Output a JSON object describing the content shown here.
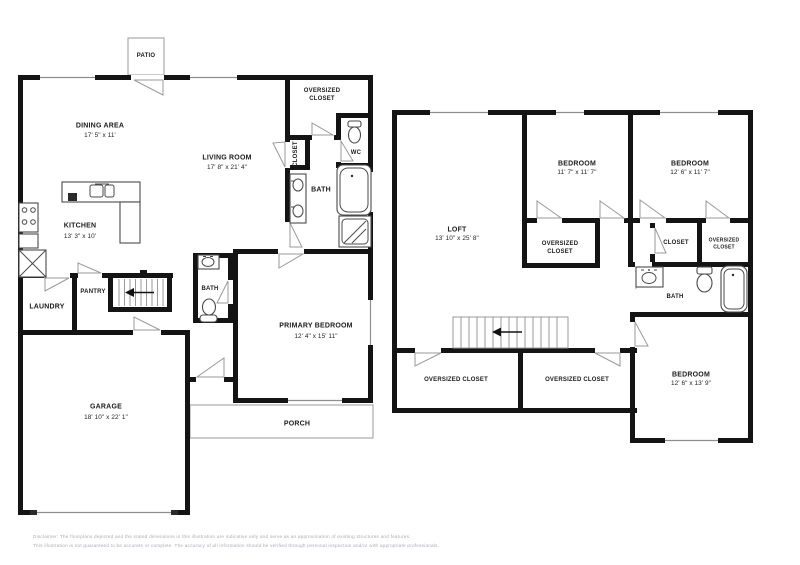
{
  "meta": {
    "width": 800,
    "height": 565,
    "background": "#ffffff",
    "wall_color": "#141414",
    "thin_line_color": "#9a9a9a",
    "text_color": "#1b1b1b",
    "disclaimer_color": "#a9a9b6"
  },
  "floor1": {
    "patio": "PATIO",
    "dining_area": {
      "name": "DINING AREA",
      "dims": "17' 5\" x 11'"
    },
    "living_room": {
      "name": "LIVING ROOM",
      "dims": "17' 8\" x 21' 4\""
    },
    "kitchen": {
      "name": "KITCHEN",
      "dims": "13' 3\" x 10'"
    },
    "oversized_closet": {
      "name": "OVERSIZED\nCLOSET"
    },
    "wc": {
      "name": "WC"
    },
    "closet": {
      "name": "CLOSET"
    },
    "bath_upper": {
      "name": "BATH"
    },
    "laundry": {
      "name": "LAUNDRY"
    },
    "pantry": {
      "name": "PANTRY"
    },
    "bath_hall": {
      "name": "BATH"
    },
    "primary_bedroom": {
      "name": "PRIMARY BEDROOM",
      "dims": "12' 4\" x 15' 11\""
    },
    "garage": {
      "name": "GARAGE",
      "dims": "18' 10\" x 22' 1\""
    },
    "porch": {
      "name": "PORCH"
    }
  },
  "floor2": {
    "loft": {
      "name": "LOFT",
      "dims": "13' 10\" x 25' 8\""
    },
    "bedroom_top_middle": {
      "name": "BEDROOM",
      "dims": "11' 7\" x 11' 7\""
    },
    "bedroom_top_right": {
      "name": "BEDROOM",
      "dims": "12' 6\" x 11' 7\""
    },
    "bedroom_bottom_right": {
      "name": "BEDROOM",
      "dims": "12' 6\" x 13' 9\""
    },
    "oversized_closet_middle": {
      "name": "OVERSIZED\nCLOSET"
    },
    "closet_hall": {
      "name": "CLOSET"
    },
    "oversized_closet_small": {
      "name": "OVERSIZED\nCLOSET"
    },
    "bath": {
      "name": "BATH"
    },
    "oversized_closet_bottom_left": {
      "name": "OVERSIZED CLOSET"
    },
    "oversized_closet_bottom_middle": {
      "name": "OVERSIZED CLOSET"
    }
  },
  "icons": [
    "toilet-icon",
    "sink-icon",
    "double-sink-icon",
    "bathtub-icon",
    "shower-icon",
    "stove-icon",
    "refrigerator-icon",
    "water-heater-icon",
    "kitchen-sink-icon",
    "dishwasher-icon",
    "stair-arrow-icon",
    "door-swing-icon",
    "window-marker",
    "staircase"
  ],
  "disclaimer": {
    "line1": "Disclaimer: The floorplans depicted and the stated dimensions in this illustration are indicative only and serve as an approximation of existing structures and features.",
    "line2": "This illustration is not guaranteed to be accurate or complete. The accuracy of all information should be verified through personal inspection and/or with appropriate professionals."
  }
}
